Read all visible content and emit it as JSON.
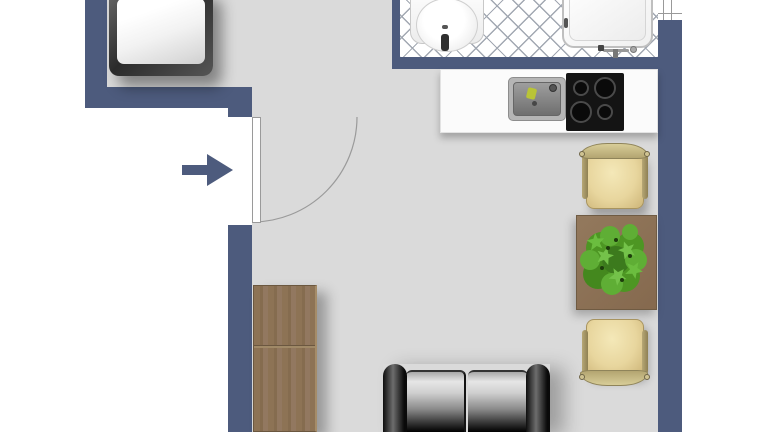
{
  "meta": {
    "view": "studio-apartment-floor-plan",
    "orientation": "top-down"
  },
  "palette": {
    "wall": "#4d5b7d",
    "floor": "#dadada",
    "outside": "#ffffff",
    "bath_tile_line": "#a2a8b2",
    "wood": "#8d7355",
    "chair_seat": "#e8d69e",
    "sofa": "#141414",
    "plant": "#4d9623",
    "arrow": "#4d5b7d"
  },
  "rooms": {
    "main_room": {
      "label": "Main room"
    },
    "sleeping_nook": {
      "label": "Sleeping nook"
    },
    "bathroom": {
      "label": "Bathroom (tiled floor)"
    },
    "kitchen": {
      "label": "Kitchenette"
    }
  },
  "fixtures": {
    "bed": {
      "label": "Bed"
    },
    "entrance_door": {
      "label": "Entrance door with swing arc"
    },
    "entrance_arrow": {
      "label": "Entrance direction arrow"
    },
    "window": {
      "label": "Window"
    },
    "washbasin": {
      "label": "Washbasin"
    },
    "bathtub": {
      "label": "Bathtub"
    },
    "counter": {
      "label": "Kitchen counter"
    },
    "sink": {
      "label": "Kitchen sink"
    },
    "cooktop": {
      "label": "Cooktop with 4 burners"
    },
    "chair_top": {
      "label": "Dining chair"
    },
    "chair_bottom": {
      "label": "Dining chair"
    },
    "table": {
      "label": "Dining table"
    },
    "plant": {
      "label": "Potted plant"
    },
    "wardrobe": {
      "label": "Wardrobe cabinet"
    },
    "sofa": {
      "label": "Two-seat sofa"
    }
  }
}
